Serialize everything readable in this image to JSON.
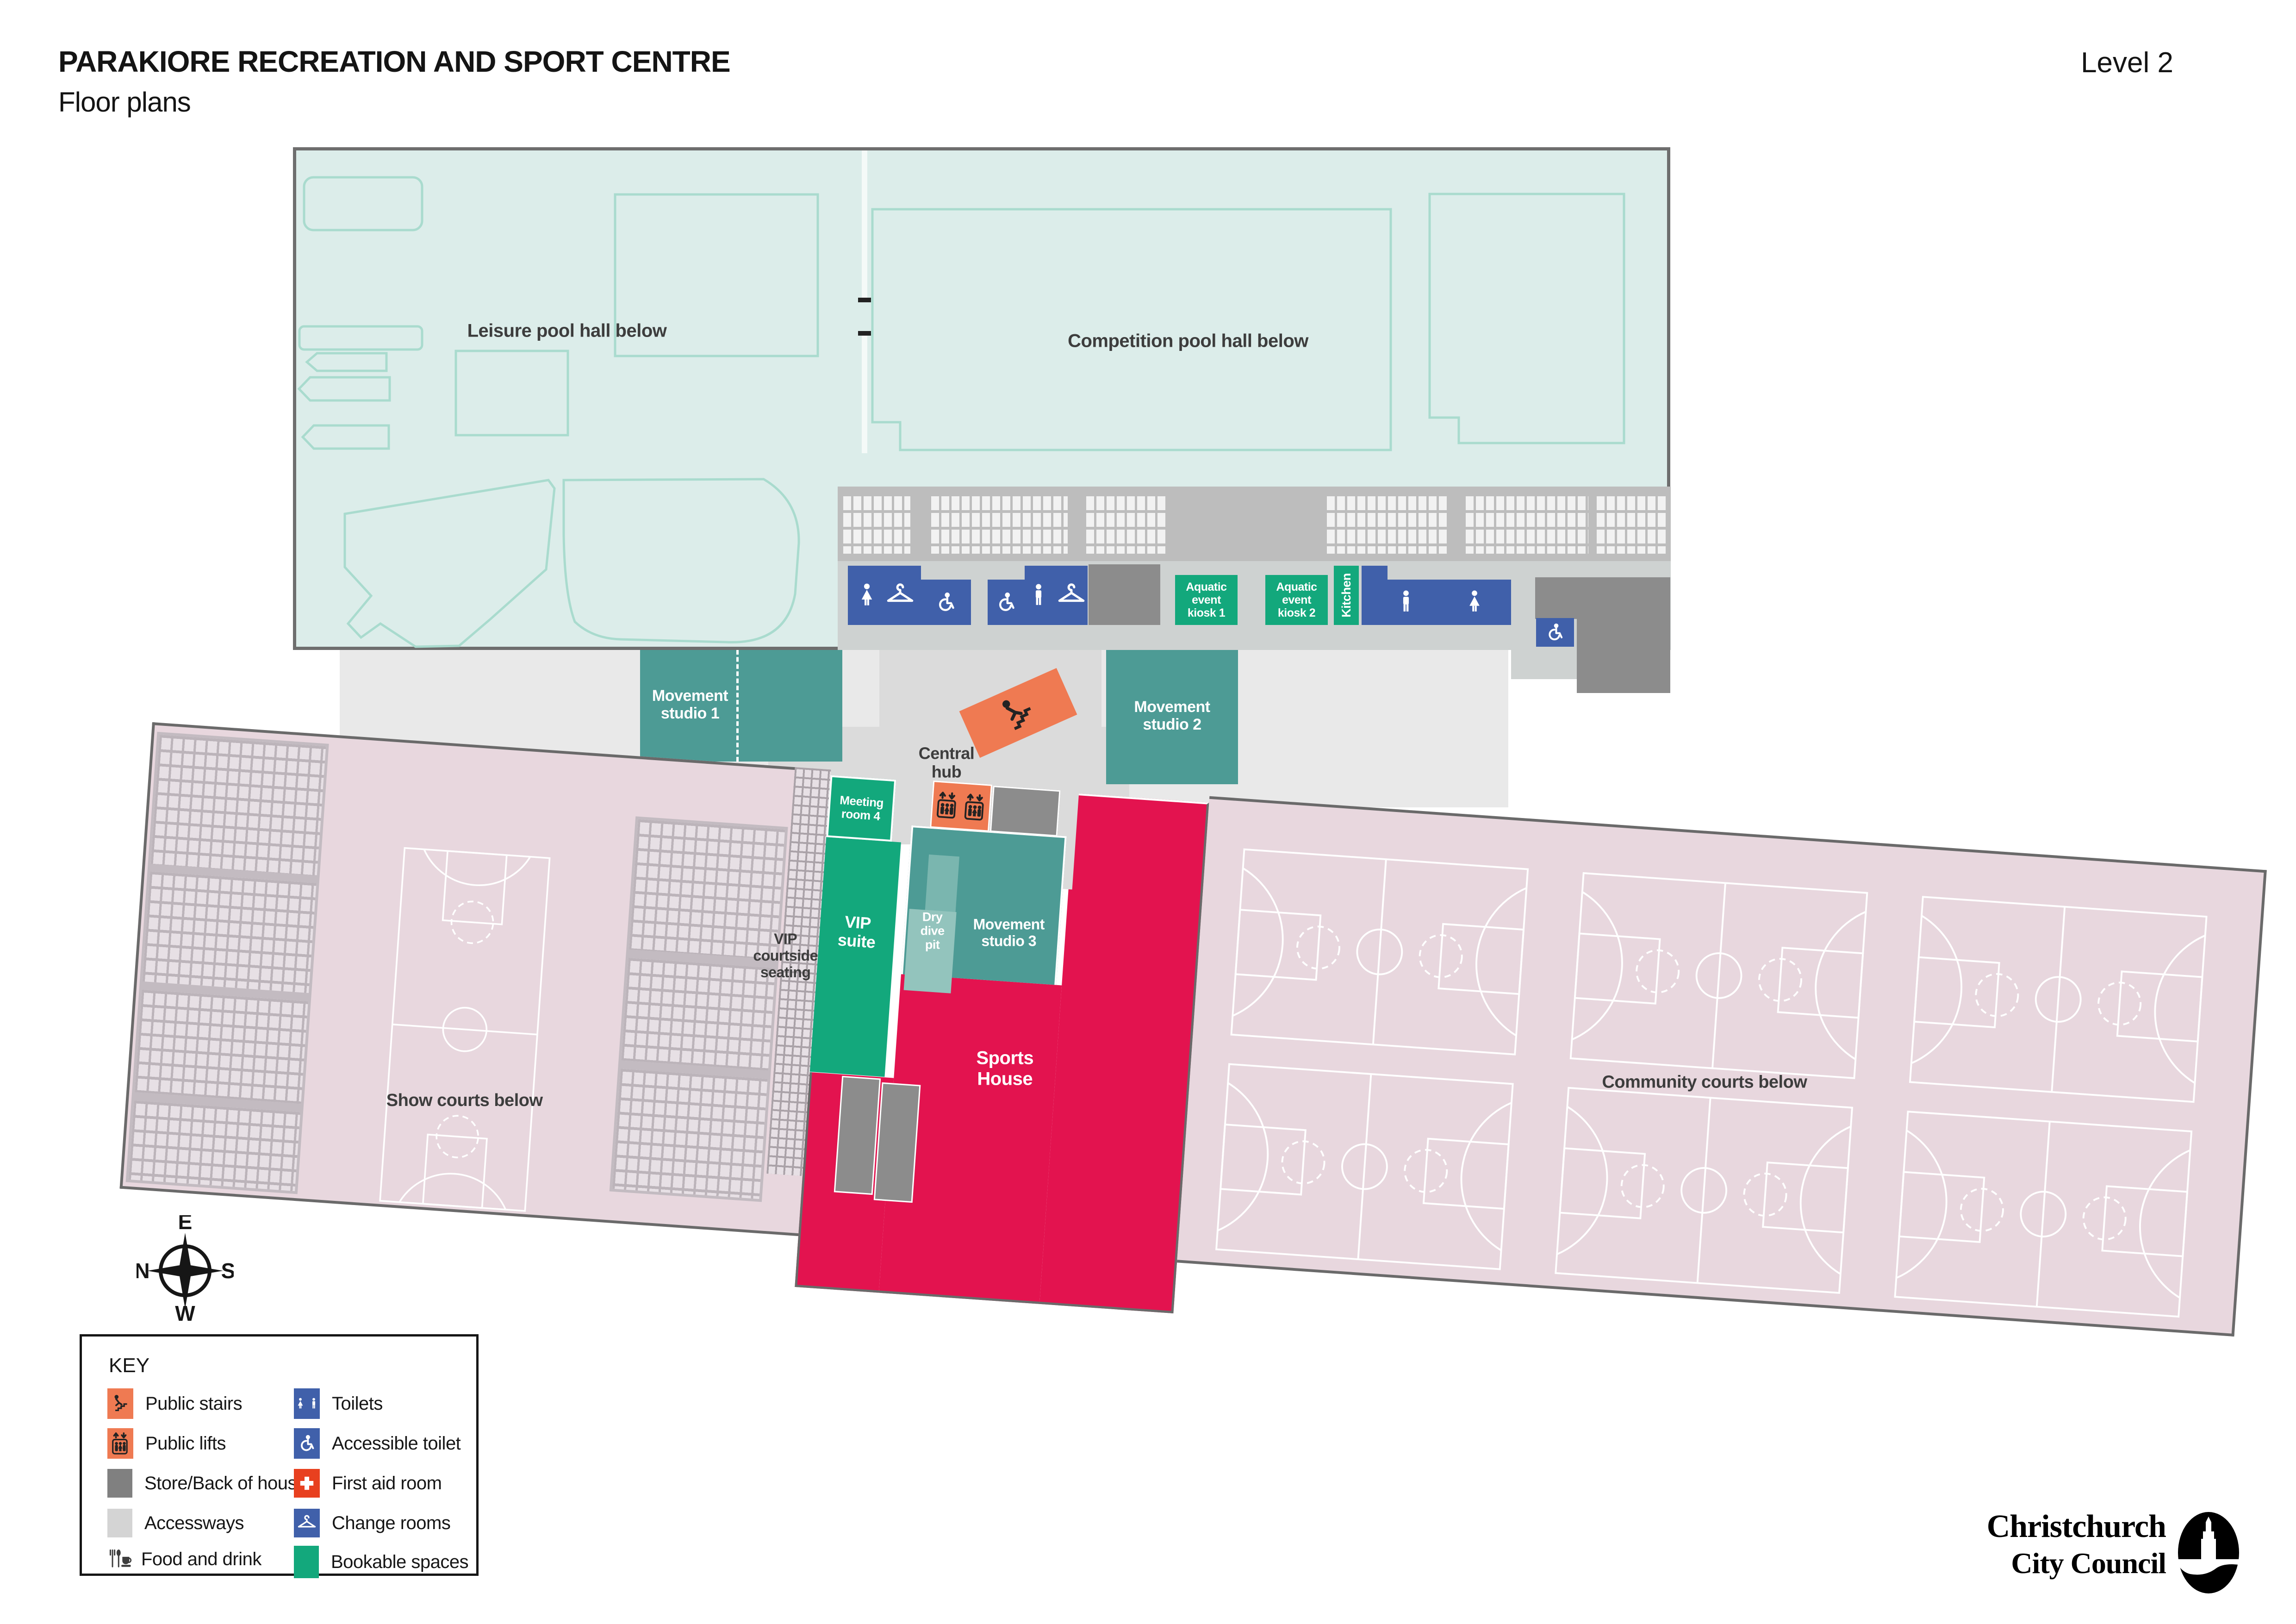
{
  "header": {
    "title": "PARAKIORE RECREATION AND SPORT CENTRE",
    "subtitle": "Floor plans",
    "level": "Level 2"
  },
  "pool_hall": {
    "leisure": "Leisure pool hall below",
    "competition": "Competition pool hall below",
    "kiosk1": "Aquatic\nevent\nkiosk 1",
    "kiosk2": "Aquatic\nevent\nkiosk 2",
    "kitchen": "Kitchen"
  },
  "central": {
    "studio1": "Movement\nstudio 1",
    "studio2": "Movement\nstudio 2",
    "hub": "Central\nhub"
  },
  "south": {
    "meeting_room4": "Meeting\nroom 4",
    "vip_suite": "VIP\nsuite",
    "vip_courtside": "VIP\ncourtside\nseating",
    "dry_dive_pit": "Dry\ndive\npit",
    "studio3": "Movement\nstudio 3",
    "sports_house": "Sports\nHouse",
    "show_courts": "Show courts below",
    "community_courts": "Community courts below"
  },
  "compass": {
    "n": "N",
    "e": "E",
    "s": "S",
    "w": "W"
  },
  "key": {
    "title": "KEY",
    "col1": [
      {
        "icon": "public-stairs-icon",
        "label": "Public stairs"
      },
      {
        "icon": "public-lifts-icon",
        "label": "Public lifts"
      },
      {
        "icon": "store-back-of-house-swatch",
        "label": "Store/Back of house"
      },
      {
        "icon": "accessways-swatch",
        "label": "Accessways"
      },
      {
        "icon": "food-and-drink-icon",
        "label": "Food and drink"
      }
    ],
    "col2": [
      {
        "icon": "toilets-icon",
        "label": "Toilets"
      },
      {
        "icon": "accessible-toilet-icon",
        "label": "Accessible toilet"
      },
      {
        "icon": "first-aid-room-icon",
        "label": "First aid room"
      },
      {
        "icon": "change-rooms-icon",
        "label": "Change rooms"
      },
      {
        "icon": "bookable-spaces-swatch",
        "label": "Bookable spaces"
      }
    ]
  },
  "logo": {
    "line1": "Christchurch",
    "line2": "City Council"
  },
  "colors": {
    "teal": "#4d9b95",
    "green": "#13a87c",
    "orange": "#ef7a52",
    "blue": "#4060aa",
    "crimson": "#e3134f",
    "mint": "#dcedea",
    "pink": "#e8d7de",
    "first_aid_red": "#e8401f",
    "back_of_house": "#8c8c8c",
    "accessway": "#d4d4d4"
  }
}
